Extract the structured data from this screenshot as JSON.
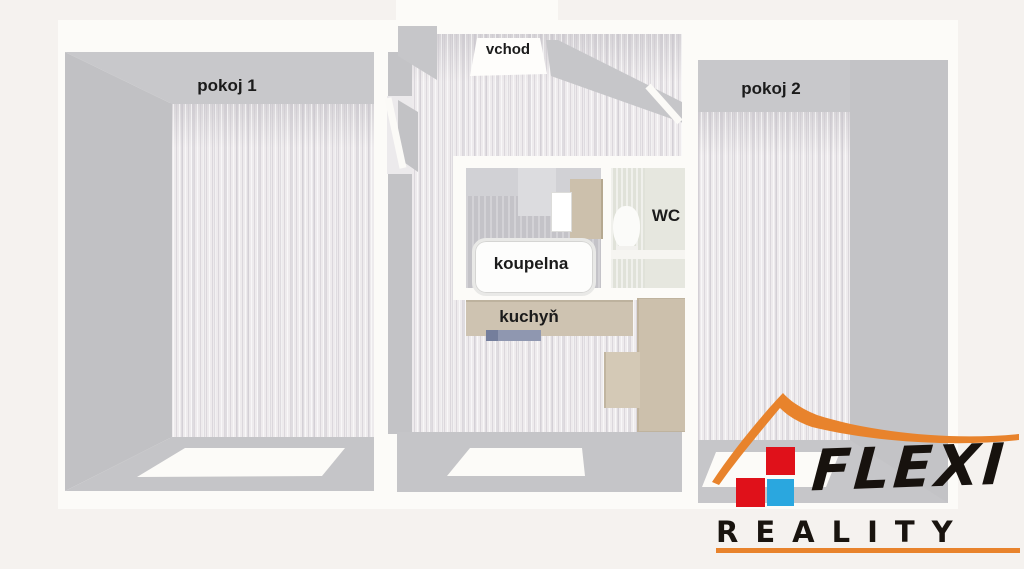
{
  "floorplan": {
    "type": "3d-top-down-floor-plan",
    "rooms": {
      "pokoj1": "pokoj 1",
      "pokoj2": "pokoj 2",
      "vchod": "vchod",
      "koupelna": "koupelna",
      "wc": "WC",
      "kuchyn": "kuchyň"
    },
    "fixtures": [
      "bathtub",
      "toilet",
      "washbasin",
      "kitchen-counter",
      "kitchen-sink",
      "cabinets",
      "windows",
      "doors"
    ]
  },
  "logo": {
    "name": "FLEXI",
    "subtitle": "REALITY",
    "symbol": "orange roof over red and blue squares",
    "colors": {
      "roof_orange": "#E8832C",
      "square_red": "#E0111A",
      "square_blue": "#2AA7DF",
      "text_black": "#17120E"
    }
  },
  "palette": {
    "page_background": "#F5F2EF",
    "outer_wall_white": "#FCFBF8",
    "wall_gray_top": "#C8C8CB",
    "wall_gray_side": "#C1C1C4",
    "wall_gray_bottom": "#C5C5C8",
    "floor_light": "#EEEBED",
    "bathroom_floor": "#C4C3C8",
    "wc_floor": "#E6E7DF",
    "counter_tan": "#CCC0AC",
    "sink_blue_gray": "#8F97B0"
  }
}
